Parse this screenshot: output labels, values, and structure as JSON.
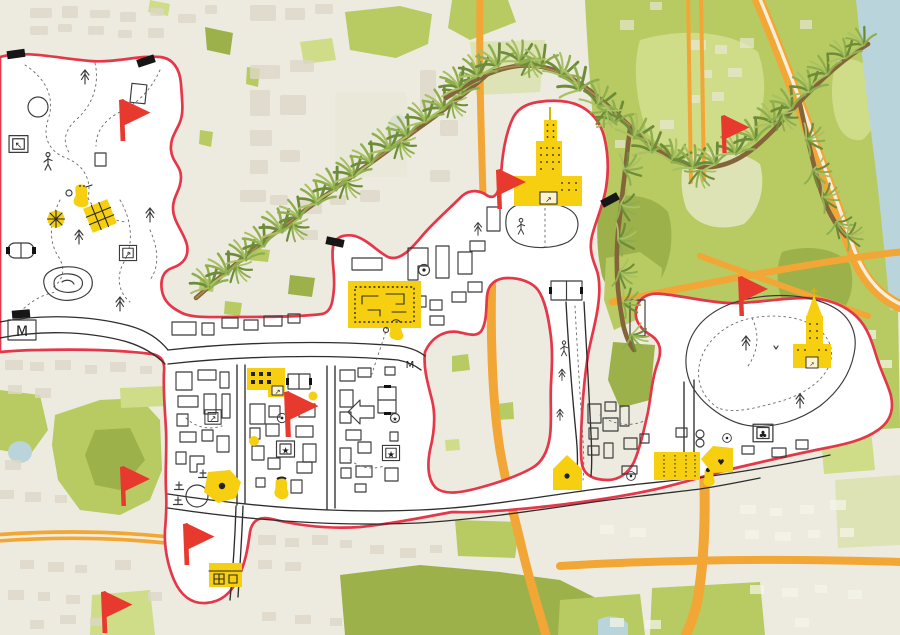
{
  "palette": {
    "paper": "#edebdf",
    "region_fill": "#ffffff",
    "boundary_red": "#e5374a",
    "flag_red": "#e8392f",
    "landmark_yellow": "#f6cf10",
    "road_orange": "#f2a636",
    "park_green": "#b8cb62",
    "water_blue": "#b9d4da",
    "ink": "#3b3b3b"
  },
  "labels": {
    "metro_left": "M",
    "metro_grid": "M"
  },
  "glyphs": {
    "star": "★",
    "club": "♣",
    "heart": "♥",
    "arrow_ne": "↗",
    "arrow_nw": "↖"
  },
  "flags": [
    {
      "id": "flag-park-west",
      "transform": "translate(119,99) scale(1.05)"
    },
    {
      "id": "flag-tower",
      "transform": "translate(496,169)"
    },
    {
      "id": "flag-northeast",
      "transform": "translate(721,115) scale(0.95)"
    },
    {
      "id": "flag-east-park",
      "transform": "translate(738,276)"
    },
    {
      "id": "flag-center-grid",
      "transform": "translate(284,391) scale(1.15)"
    },
    {
      "id": "flag-west-outside",
      "transform": "translate(120,466)"
    },
    {
      "id": "flag-south-lobe",
      "transform": "translate(183,523) scale(1.05)"
    },
    {
      "id": "flag-southwest",
      "transform": "translate(101,591) scale(1.05)"
    }
  ],
  "markers": [
    {
      "id": "yellow-tower",
      "type": "skyscraper-landmark"
    },
    {
      "id": "yellow-church",
      "type": "church-landmark"
    },
    {
      "id": "yellow-plan-square",
      "type": "building-plan"
    },
    {
      "id": "yellow-window-block",
      "type": "apartment-block"
    },
    {
      "id": "yellow-grid-house",
      "type": "small-building"
    },
    {
      "id": "yellow-striped-block",
      "type": "market-block"
    },
    {
      "id": "heart-house",
      "type": "house"
    },
    {
      "id": "pentagon-house",
      "type": "house"
    },
    {
      "id": "pentagon-blob",
      "type": "playground"
    },
    {
      "id": "sun-wheel",
      "type": "carousel"
    },
    {
      "id": "tennis-court",
      "type": "court"
    }
  ]
}
